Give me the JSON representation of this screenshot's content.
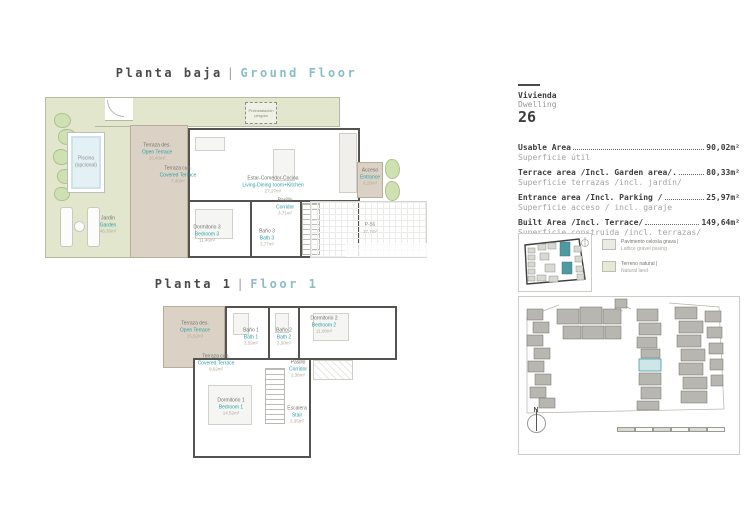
{
  "titles": {
    "ground_es": "Planta baja",
    "ground_en": "Ground Floor",
    "first_es": "Planta 1",
    "first_en": "Floor 1",
    "sep": "|"
  },
  "dwelling": {
    "es": "Vivienda",
    "en": "Dwelling",
    "number": "26"
  },
  "areas": [
    {
      "label": "Usable Area",
      "value": "90,02m²",
      "sub": "Superficie útil"
    },
    {
      "label": "Terrace area /Incl. Garden area/.",
      "value": "80,33m²",
      "sub": "Superficie terrazas /incl. jardín/"
    },
    {
      "label": "Entrance area /Incl. Parking /",
      "value": "25,97m²",
      "sub": "Superficie acceso / incl. garaje"
    },
    {
      "label": "Built Area /Incl. Terrace/",
      "value": "149,64m²",
      "sub": "Superficie construida /incl. terrazas/"
    }
  ],
  "legend": [
    {
      "es": "Pavimento celosía grava |",
      "en": "Lattice gravel paving",
      "color": "#ecebe3"
    },
    {
      "es": "Terreno natural |",
      "en": "Natural land",
      "color": "#e6e9d3"
    }
  ],
  "gf_rooms": [
    {
      "es": "Piscina",
      "en": "(opcional)",
      "area": ""
    },
    {
      "es": "Terraza des.",
      "en": "Open Terrace",
      "area": "16,40m²"
    },
    {
      "es": "Terraza cub.",
      "en": "Covered Terrace",
      "area": "7,40m²"
    },
    {
      "es": "Jardín",
      "en": "Garden",
      "area": "46,36m²"
    },
    {
      "es": "Estar-Comedor-Cocina",
      "en": "Living-Dining room+Kitchen",
      "area": "27,27m²"
    },
    {
      "es": "Dormitorio 3",
      "en": "Bedroom 3",
      "area": "11,46m²"
    },
    {
      "es": "Baño 3",
      "en": "Bath 3",
      "area": "3,77m²"
    },
    {
      "es": "Pasillo",
      "en": "Corridor",
      "area": "3,71m²"
    },
    {
      "es": "Acceso",
      "en": "Entrance",
      "area": "6,28m²"
    },
    {
      "es": "P-56",
      "en": "",
      "area": "17,7m²"
    }
  ],
  "f1_rooms": [
    {
      "es": "Terraza des.",
      "en": "Open Terrace",
      "area": "15,92m²"
    },
    {
      "es": "Terraza cub.",
      "en": "Covered Terrace",
      "area": "9,62m²"
    },
    {
      "es": "Baño 1",
      "en": "Bath 1",
      "area": "3,59m²"
    },
    {
      "es": "Baño 2",
      "en": "Bath 2",
      "area": "3,50m²"
    },
    {
      "es": "Dormitorio 2",
      "en": "Bedroom 2",
      "area": "11,08m²"
    },
    {
      "es": "Pasillo",
      "en": "Corridor",
      "area": "2,38m²"
    },
    {
      "es": "Dormitorio 1",
      "en": "Bedroom 1",
      "area": "14,52m²"
    },
    {
      "es": "Escalera",
      "en": "Stair",
      "area": "2,35m²"
    }
  ],
  "pergola": {
    "line1": "Preinstalación",
    "line2": "pérgola"
  },
  "compass": {
    "label": "N"
  },
  "colors": {
    "accent_teal": "#2fa0a8",
    "title_teal": "#8abdc4",
    "text_dark": "#3d3d3d",
    "text_gray": "#9a9a9a",
    "garden_green": "#e1e6cd",
    "terrace_tan": "#dbd2c5",
    "pool_blue": "#e3f0f4",
    "site_building_gray": "#b8b6b0",
    "highlight_unit": "#cde6e8"
  }
}
